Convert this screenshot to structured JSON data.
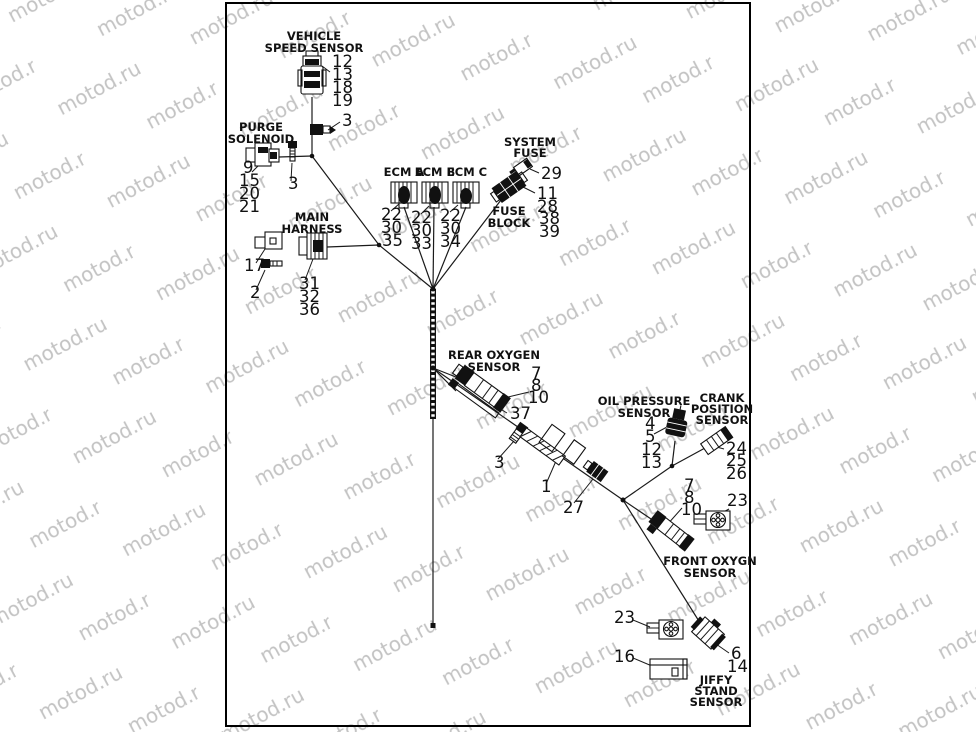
{
  "watermark": "motod.ru",
  "colors": {
    "background": "#ffffff",
    "line": "#1a1a1a",
    "watermark_gray": "#c3c3c3",
    "border": "#000000"
  },
  "labels": {
    "vss1": "VEHICLE",
    "vss2": "SPEED SENSOR",
    "purge1": "PURGE",
    "purge2": "SOLENOID",
    "main1": "MAIN",
    "main2": "HARNESS",
    "ecm_a": "ECM A",
    "ecm_b": "ECM B",
    "ecm_c": "ECM C",
    "sysfuse1": "SYSTEM",
    "sysfuse2": "FUSE",
    "fuseblock1": "FUSE",
    "fuseblock2": "BLOCK",
    "rear1": "REAR OXYGEN",
    "rear2": "SENSOR",
    "oil1": "OIL PRESSURE",
    "oil2": "SENSOR",
    "crank1": "CRANK",
    "crank2": "POSITION",
    "crank3": "SENSOR",
    "front1": "FRONT OXYGN",
    "front2": "SENSOR",
    "jiffy1": "JIFFY",
    "jiffy2": "STAND",
    "jiffy3": "SENSOR"
  },
  "callouts": {
    "vss": [
      "12",
      "13",
      "18",
      "19"
    ],
    "vss_clip": "3",
    "purge": [
      "9",
      "15",
      "20",
      "21"
    ],
    "purge_bolt": "3",
    "c17": "17",
    "b2": "2",
    "main": [
      "31",
      "32",
      "36"
    ],
    "ecm_a": [
      "22",
      "30",
      "35"
    ],
    "ecm_b": [
      "22",
      "30",
      "33"
    ],
    "ecm_c": [
      "22",
      "30",
      "34"
    ],
    "system_fuse": "29",
    "fuse_block": [
      "11",
      "28",
      "38",
      "39"
    ],
    "rear_oxy": [
      "7",
      "8",
      "10"
    ],
    "rear_bracket": "37",
    "clip3": "3",
    "conduit": "1",
    "c27": "27",
    "oil": [
      "4",
      "5",
      "12",
      "13"
    ],
    "crank": [
      "24",
      "25",
      "26"
    ],
    "front_oxy": [
      "7",
      "8",
      "10"
    ],
    "c23_front": "23",
    "c23_bottom": "23",
    "c16": "16",
    "jiffy": [
      "6",
      "14"
    ]
  }
}
